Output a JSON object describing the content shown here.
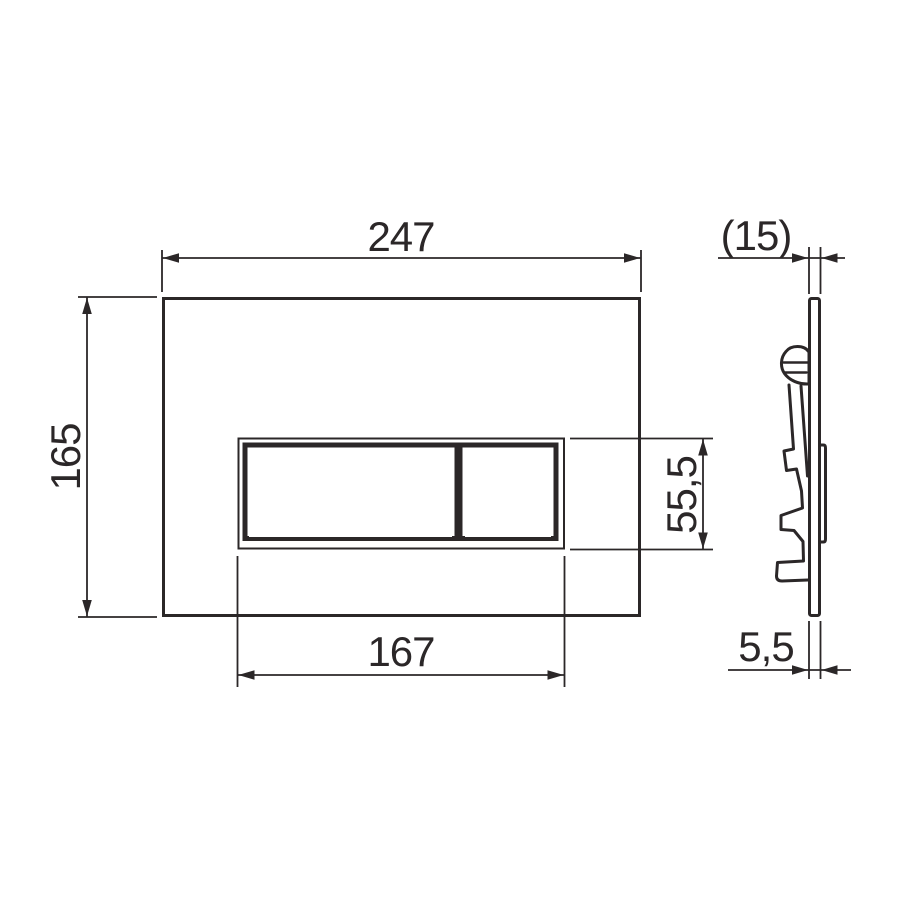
{
  "document": {
    "type": "technical-dimension-drawing",
    "subject": "dual-flush wall plate, front view and side profile with mounting clip"
  },
  "colors": {
    "line": "#2b2728",
    "background": "#ffffff"
  },
  "dimensions": {
    "plate_width": "247",
    "plate_height": "165",
    "button_panel_width": "167",
    "button_panel_height": "55,5",
    "depth": "(15)",
    "thickness": "5,5"
  }
}
